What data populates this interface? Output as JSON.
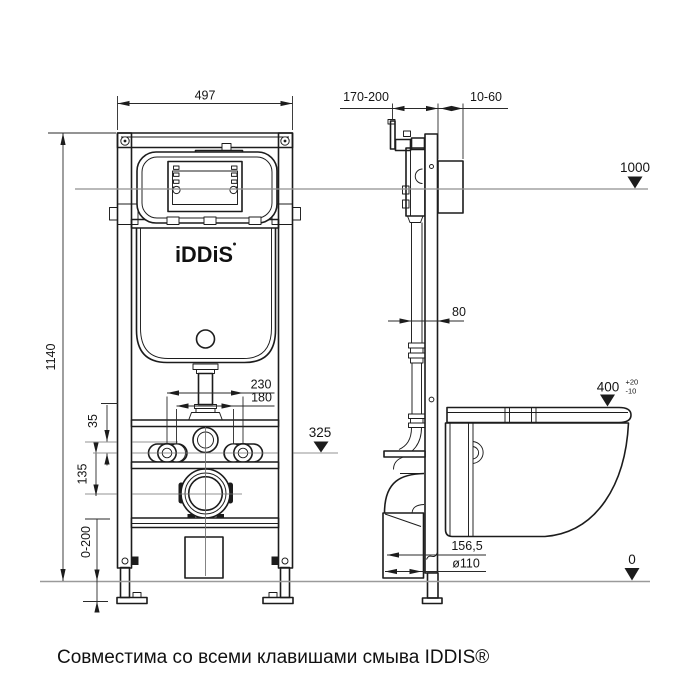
{
  "drawing": {
    "front": {
      "width": "497",
      "height": "1140",
      "stud_spacing_outer": "230",
      "stud_spacing_inner": "180",
      "flush_offset": "35",
      "outlet_offset": "135",
      "leg_adjustment": "0-200"
    },
    "side": {
      "frame_offset": "170-200",
      "finish_layer": "10-60",
      "profile_depth": "80",
      "drain_offset": "156,5",
      "drain_diameter": "ø110"
    },
    "levels": {
      "panel": "1000",
      "fixture_axis": "325",
      "bowl_rim": "400",
      "bowl_rim_tol_plus": "+20",
      "bowl_rim_tol_minus": "-10",
      "floor": "0"
    },
    "logo": "iDDiS",
    "caption": "Совместима со всеми клавишами смыва IDDIS®"
  },
  "colors": {
    "line": "#1c1c1c",
    "level_line": "#8f8f8f",
    "floor_line": "#9a9a9a",
    "text": "#151515",
    "background": "#ffffff"
  }
}
